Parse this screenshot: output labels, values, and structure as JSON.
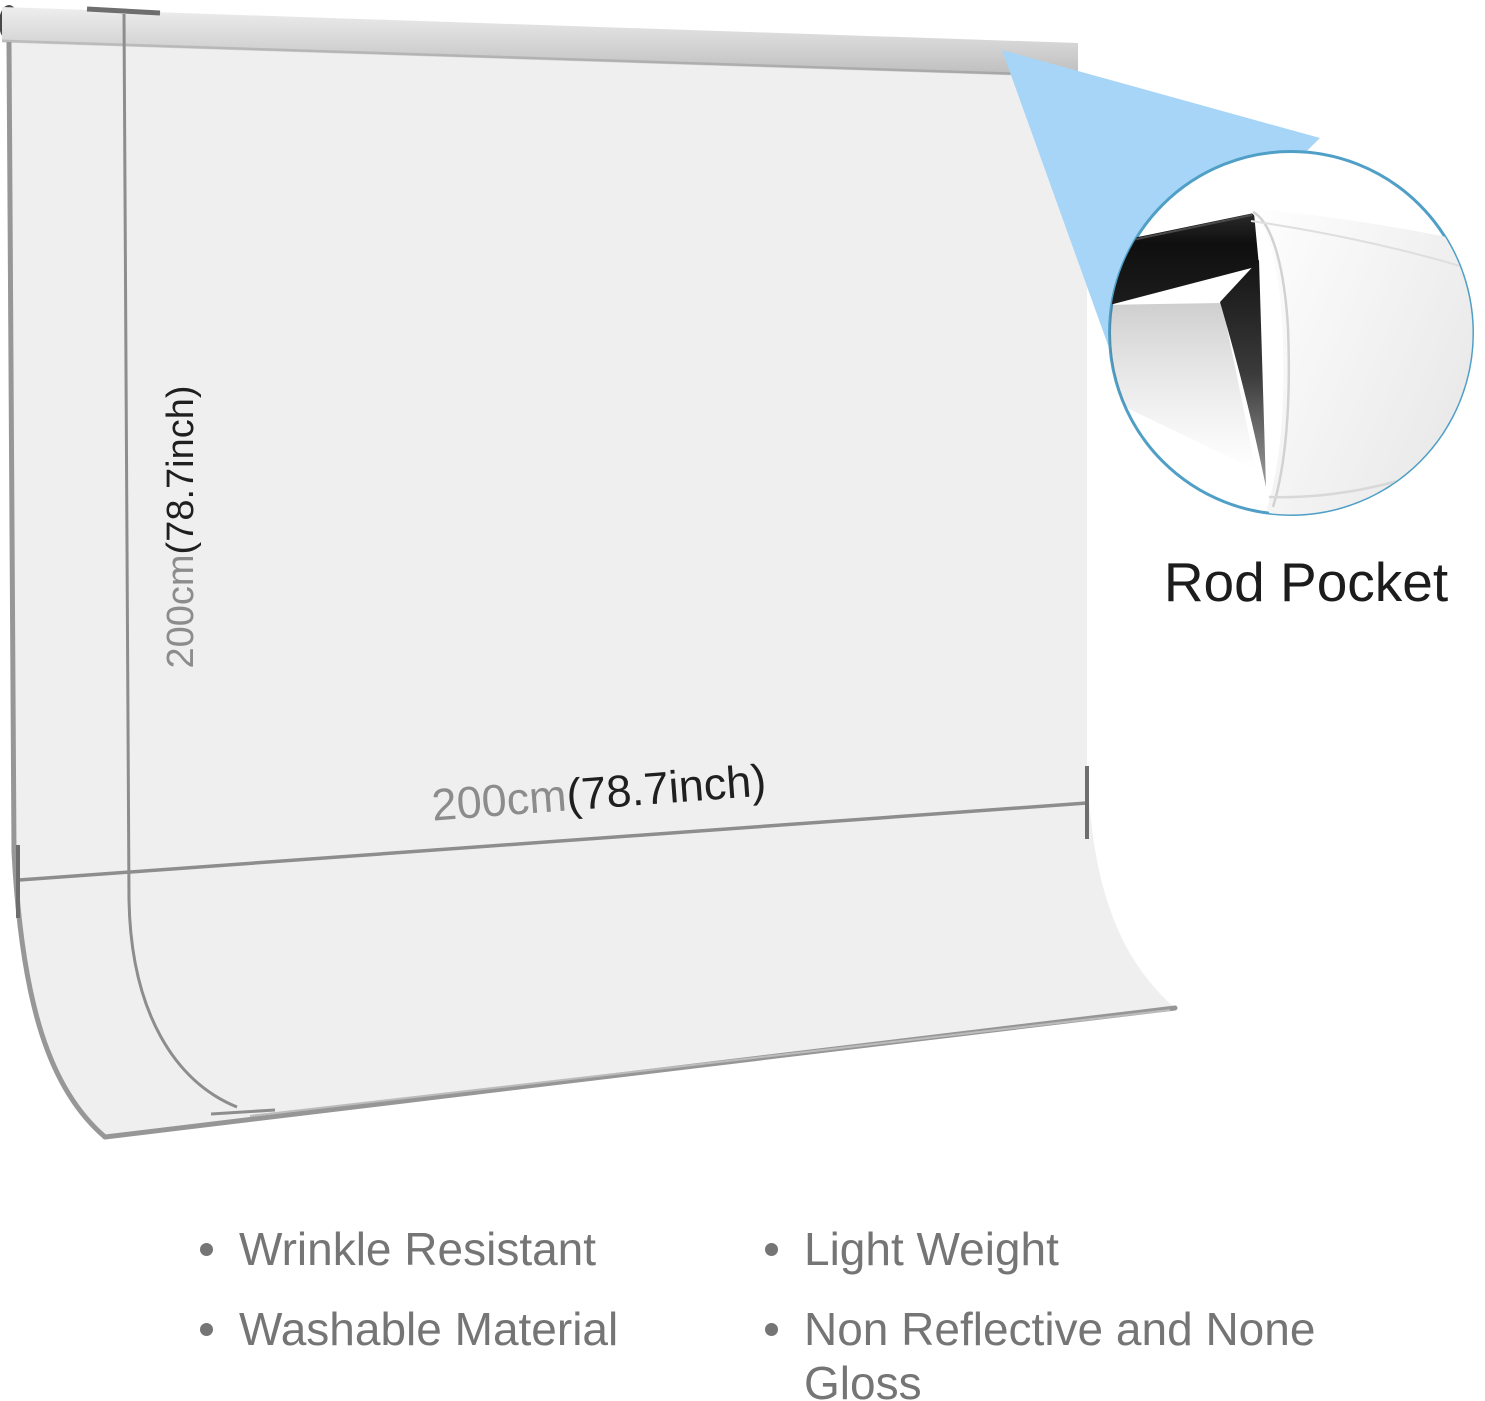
{
  "colors": {
    "accent-blue": "#a6d5f7",
    "ring-blue": "#4f9fc6",
    "fabric-gray": "#efefef",
    "edge-gray": "#979797",
    "dim-line-gray": "#8d8d8d",
    "tick-gray": "#6e6e6e",
    "dim-text-gray": "#8c8c8c",
    "dim-text-dark": "#1f1f1f",
    "feature-text-gray": "#757575",
    "callout-text-dark": "#1c1c1c"
  },
  "diagram": {
    "height_dimension": {
      "metric": "200cm",
      "imperial": "(78.7inch)"
    },
    "width_dimension": {
      "metric": "200cm",
      "imperial": "(78.7inch)"
    },
    "callout_label": "Rod Pocket"
  },
  "features": {
    "left": [
      "Wrinkle Resistant",
      "Washable Material"
    ],
    "right": [
      "Light Weight",
      "Non Reflective and None Gloss"
    ]
  }
}
